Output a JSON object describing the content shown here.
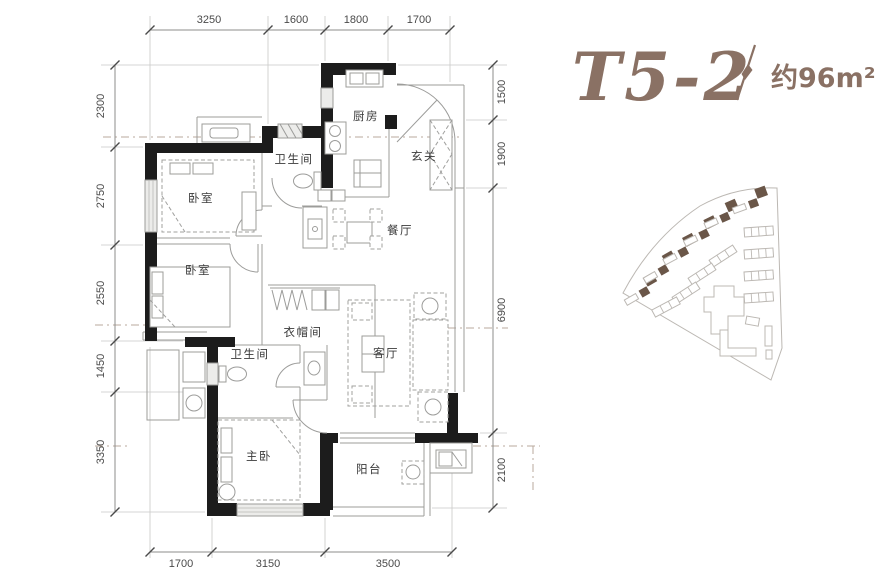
{
  "title": {
    "model": "T5-2",
    "divider": "/",
    "area": "约96m²"
  },
  "rooms": [
    {
      "id": "kitchen",
      "label": "厨房"
    },
    {
      "id": "entry",
      "label": "玄关"
    },
    {
      "id": "bath-top",
      "label": "卫生间"
    },
    {
      "id": "dining",
      "label": "餐厅"
    },
    {
      "id": "bedroom-1",
      "label": "卧室"
    },
    {
      "id": "bedroom-2",
      "label": "卧室"
    },
    {
      "id": "cloakroom",
      "label": "衣帽间"
    },
    {
      "id": "bath-lower",
      "label": "卫生间"
    },
    {
      "id": "living",
      "label": "客厅"
    },
    {
      "id": "master-bedroom",
      "label": "主卧"
    },
    {
      "id": "balcony",
      "label": "阳台"
    }
  ],
  "dimensions": {
    "top": [
      "3250",
      "1600",
      "1800",
      "1700"
    ],
    "left": [
      "2300",
      "2750",
      "2550",
      "1450",
      "3350"
    ],
    "right": [
      "1500",
      "1900",
      "6900",
      "2100"
    ],
    "bottom": [
      "1700",
      "3150",
      "3500"
    ]
  },
  "colors": {
    "accent": "#8a7164",
    "wall": "#1c1c1c",
    "thin_line": "#9c9c9a",
    "dim_text": "#4a4a4a",
    "site_building": "#6a5648",
    "site_outline": "#bcb8b3"
  }
}
